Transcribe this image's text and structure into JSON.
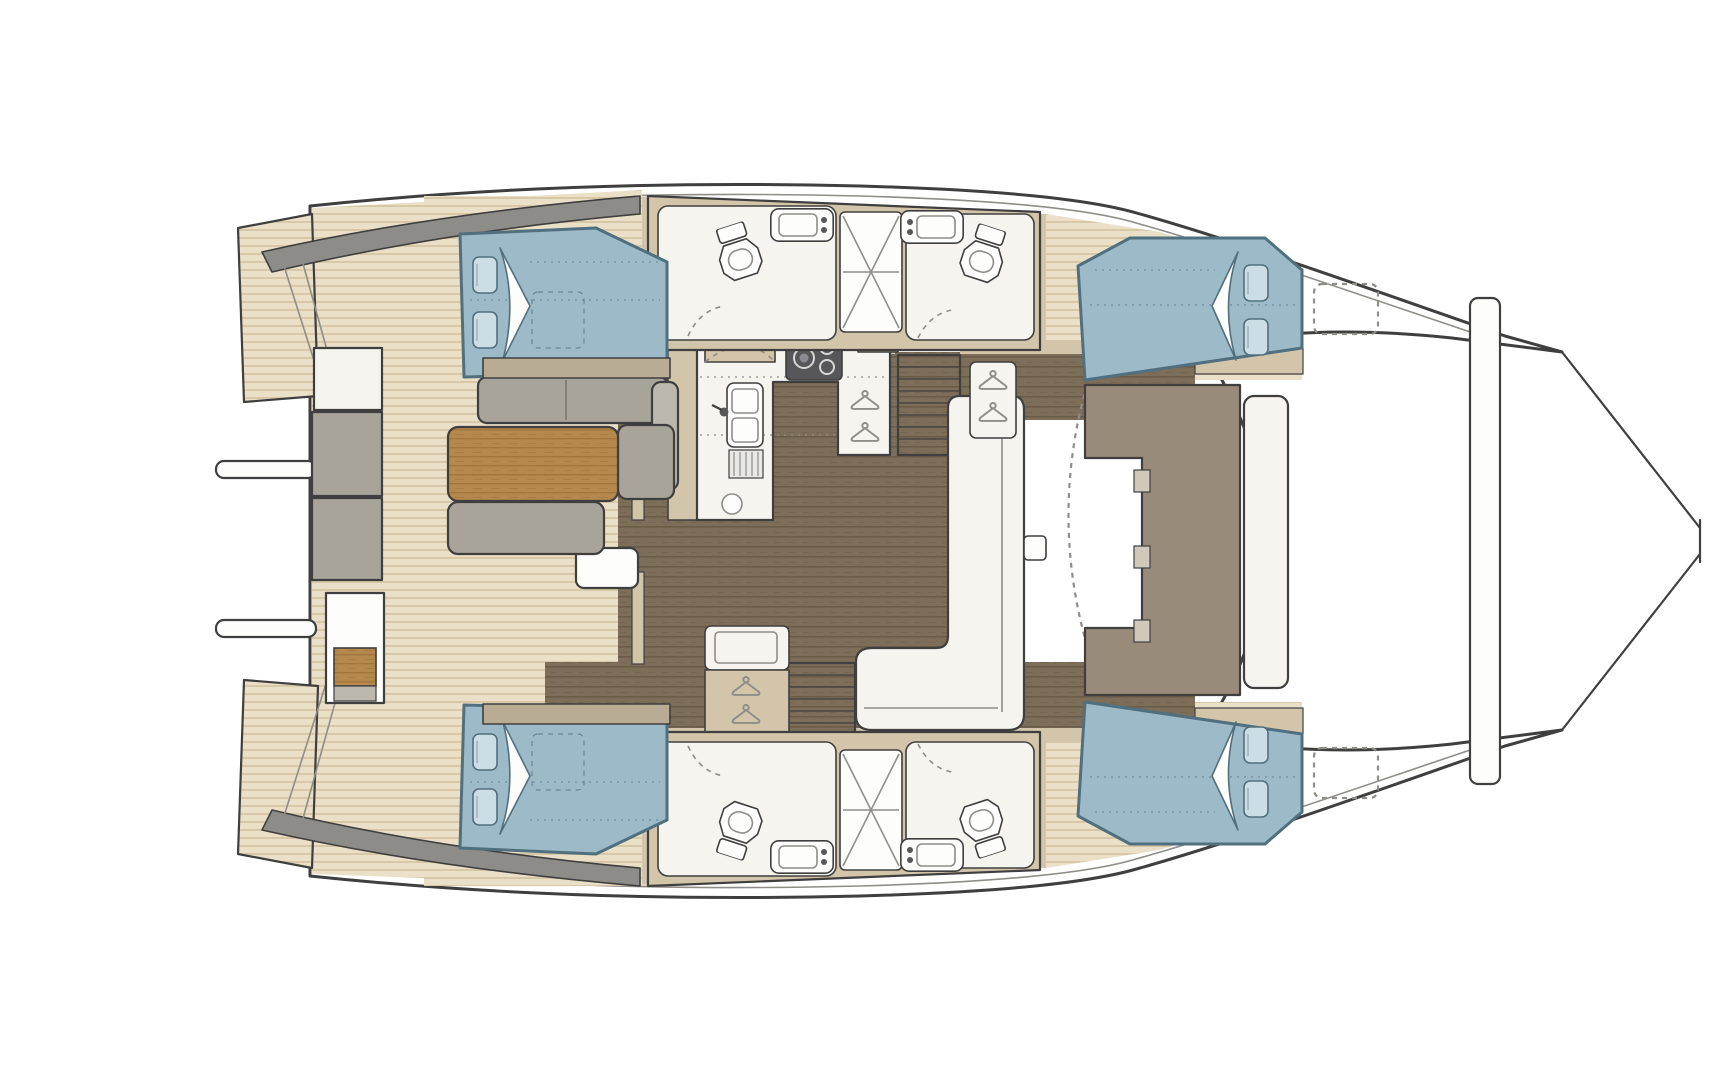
{
  "meta": {
    "description": "Catamaran yacht interior floor plan, top-down view: four double-bed cabins, four bathrooms with central showers, galley with stove and sink, salon dinette with wood table, forward cockpit bench, aft cockpit with bench seating, bow crossbeam and trampoline"
  },
  "colors": {
    "outline": "#3f3f3f",
    "line_soft": "#8f8d88",
    "hull_white": "#ffffff",
    "white": "#fdfdfc",
    "fixture": "#f6f4ee",
    "deck_base": "#eadfc7",
    "deck_stripe": "#d8c8a7",
    "wall": "#d3c5aa",
    "wall_dark": "#b9ac94",
    "coaming": "#8e8c88",
    "wood_floor": "#7d6e59",
    "wood_grain": "#6b5c47",
    "table_wood": "#b5884e",
    "table_grain": "#a2763d",
    "cushion": "#a9a49a",
    "cushion_light": "#bdb8ae",
    "bed": "#9dbac9",
    "bed_dark": "#51707f",
    "pillow": "#cddde6",
    "fwd_seat": "#998b7a",
    "fwd_seat_light": "#cfc8bb",
    "steel": "#57575a"
  },
  "icons": [
    "hanger-icon",
    "toilet-icon",
    "sink-icon",
    "shower-icon",
    "stove-icon",
    "faucet-icon",
    "hatch-icon",
    "pillow-icon"
  ]
}
